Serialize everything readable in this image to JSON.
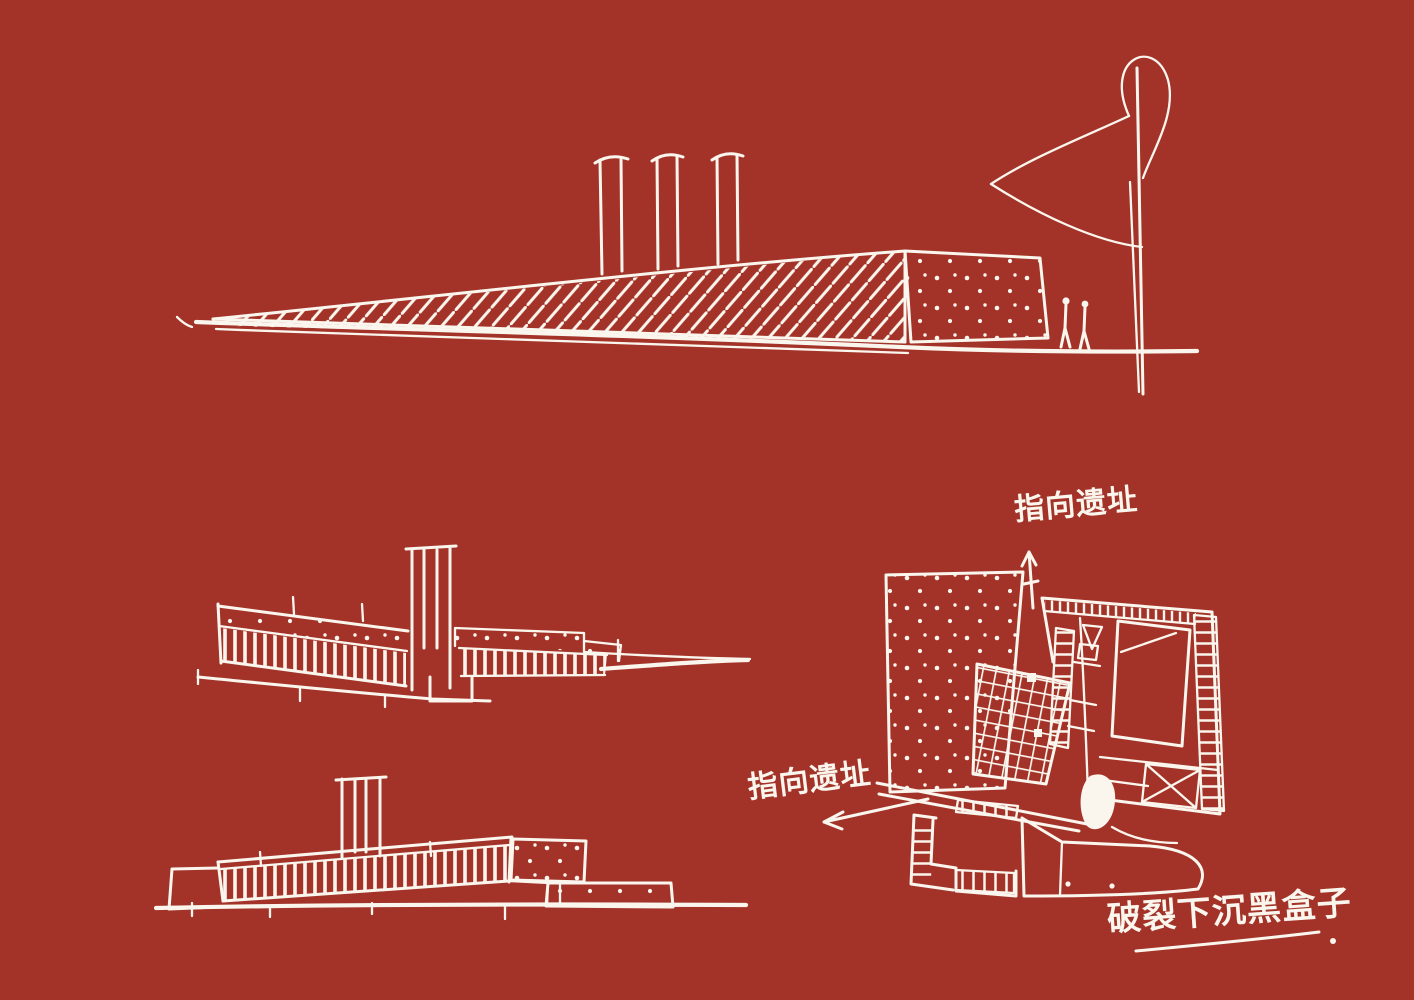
{
  "page": {
    "background_color": "#A33328",
    "ink_color": "#FAF6EE"
  },
  "annotations": {
    "plan_top_label": "指向遗址",
    "plan_left_label": "指向遗址",
    "concept_caption": "破裂下沉黑盒子"
  }
}
